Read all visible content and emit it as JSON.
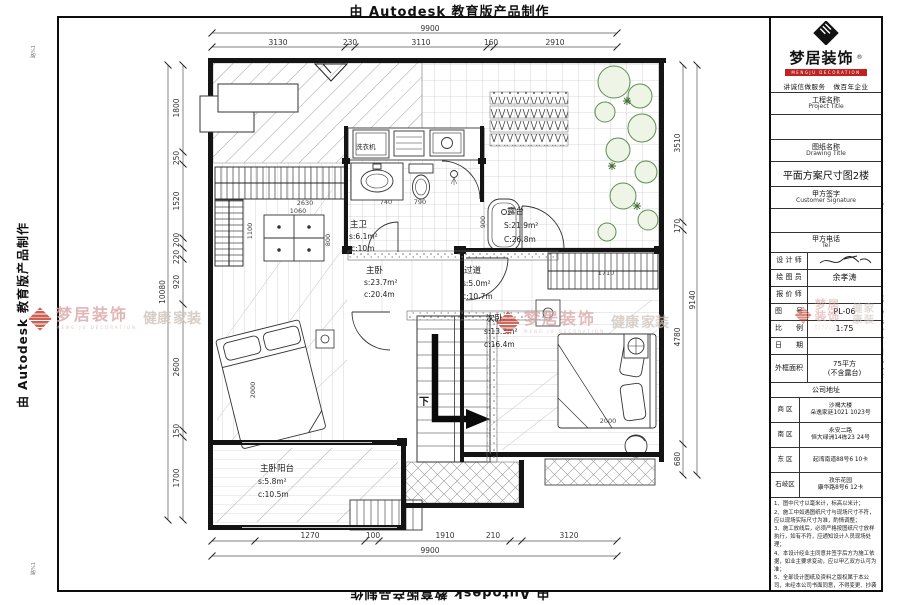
{
  "banner": {
    "text": "由 Autodesk 教育版产品制作",
    "corner_mark": "路%1"
  },
  "watermark": {
    "brand": "梦居装饰",
    "sub": "MENG JU DECORATION",
    "tag1": "健康",
    "tag2": "家装"
  },
  "title_block": {
    "logo": {
      "brand": "梦居装饰",
      "reg": "®",
      "sub": "MENGJU DECORATION",
      "slogan_left": "讲诚信做服务",
      "slogan_right": "做百年企业"
    },
    "project": {
      "cn": "工程名称",
      "en": "Project Title",
      "value": ""
    },
    "drawing": {
      "cn": "图纸名称",
      "en": "Drawing Title",
      "value": "平面方案尺寸图2楼"
    },
    "signature": {
      "cn": "甲方签字",
      "en": "Customer Signature",
      "value": ""
    },
    "tel": {
      "cn": "甲方电话",
      "en": "Tel",
      "value": ""
    },
    "rows": [
      {
        "label": "设 计 师",
        "value": ""
      },
      {
        "label": "绘 图 员",
        "value": "余孝涛"
      },
      {
        "label": "报 价 师",
        "value": ""
      },
      {
        "label": "图　　号",
        "value": "PL-06"
      },
      {
        "label": "比　　例",
        "value": "1:75"
      },
      {
        "label": "日　　期",
        "value": ""
      },
      {
        "label": "外框面积",
        "value": "75平方",
        "value2": "(不含露台)"
      }
    ],
    "address_header": "公司地址",
    "addresses": [
      {
        "district": "商  区",
        "line1": "沙褐大楼",
        "line2": "朵逸家廷1021 1023号"
      },
      {
        "district": "南  区",
        "line1": "永安二路",
        "line2": "恒大绿洲14栋23 24号"
      },
      {
        "district": "东  区",
        "line1": "起湾南道88号6  10卡",
        "line2": ""
      },
      {
        "district": "石岐区",
        "line1": "孜乐花园",
        "line2": "康华路8号6 12卡"
      }
    ],
    "notes": [
      "1、图中尺寸以毫米计，标高以米计；",
      "2、施工中如遇图纸尺寸与现场尺寸不符，应以现场实际尺寸为准，酌情调整；",
      "3、施工放线后，必须严格按图纸尺寸放样执行，如有不符，应通知设计人员现场处理；",
      "4、本设计经业主同意并签字后方为施工依据，如业主要求变动，应以甲乙双方认可为准；",
      "5、全部设计图纸及资料之版权属于本公司，未经本公司书面同意，不得变更、抄袭及复制。"
    ]
  },
  "plan": {
    "rooms": [
      {
        "name": "主卧",
        "s": "s:23.7m²",
        "c": "c:20.4m"
      },
      {
        "name": "主卫",
        "s": "s:6.1m²",
        "c": "c:10m"
      },
      {
        "name": "过道",
        "s": "s:5.0m²",
        "c": "c:10.7m"
      },
      {
        "name": "次卧",
        "s": "s:13.3m²",
        "c": "c:16.4m"
      },
      {
        "name": "露台",
        "s": "S:21.9m²",
        "c": "C:26.8m"
      },
      {
        "name": "主卧阳台",
        "s": "s:5.8m²",
        "c": "c:10.5m"
      }
    ],
    "labels": {
      "washer": "洗衣机",
      "down": "下"
    },
    "dims": {
      "top": {
        "total": "9900",
        "segs": [
          "3130",
          "230",
          "3110",
          "160",
          "2910"
        ]
      },
      "bottom": {
        "total": "9900",
        "segs": [
          "1270",
          "100",
          "1910",
          "210",
          "3120"
        ]
      },
      "left": {
        "total": "10080",
        "segs": [
          "1800",
          "250",
          "1520",
          "200",
          "220",
          "920",
          "2600",
          "150",
          "1700"
        ]
      },
      "right": {
        "total": "9140",
        "segs": [
          "3510",
          "170",
          "4780",
          "680"
        ]
      },
      "inner": {
        "wardrobe": "2630",
        "table_w": "1060",
        "closet": "1100",
        "table_h": "800",
        "bath1": "740",
        "bath2": "790",
        "tub": "900",
        "closet2": "1710",
        "bed_master": "2000",
        "bed_second": "2000"
      }
    }
  },
  "colors": {
    "plant": "#5a8f4e",
    "watermark_red": "#c0392b",
    "accent_red": "#c02222"
  }
}
